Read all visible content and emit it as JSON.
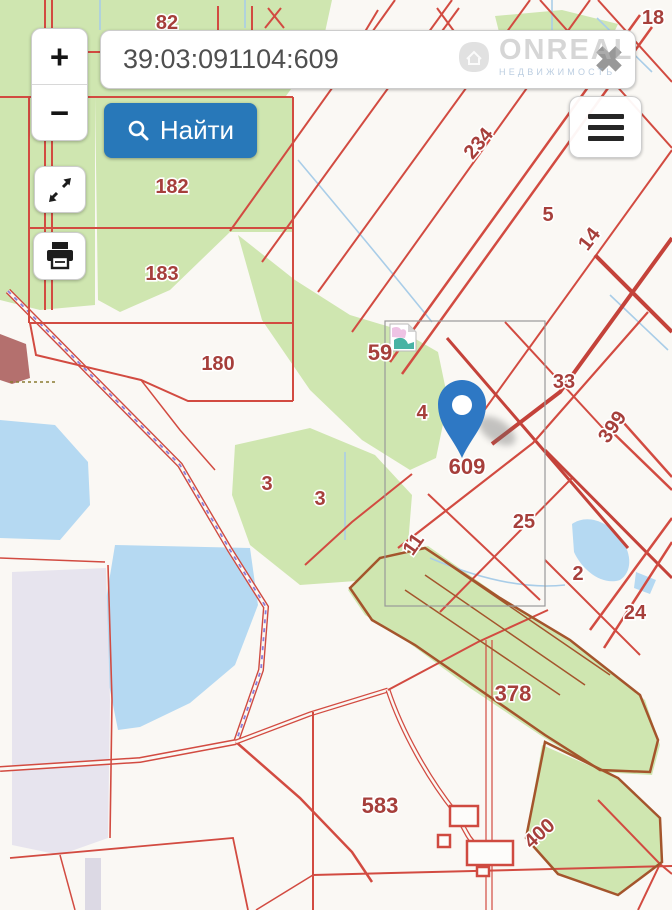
{
  "header": {
    "search": {
      "value": "39:03:091104:609",
      "clear_icon": "✖",
      "find_label": "Найти"
    },
    "zoom_in": "+",
    "zoom_out": "−",
    "watermark": {
      "brand": "ONREAL",
      "tagline": "НЕДВИЖИМОСТЬ"
    }
  },
  "map": {
    "pin_parcel": "609",
    "labels": [
      {
        "text": "82"
      },
      {
        "text": "18"
      },
      {
        "text": "234"
      },
      {
        "text": "5"
      },
      {
        "text": "14"
      },
      {
        "text": "182"
      },
      {
        "text": "183"
      },
      {
        "text": "180"
      },
      {
        "text": "59"
      },
      {
        "text": "4"
      },
      {
        "text": "33"
      },
      {
        "text": "399"
      },
      {
        "text": "609"
      },
      {
        "text": "25"
      },
      {
        "text": "11"
      },
      {
        "text": "3"
      },
      {
        "text": "3"
      },
      {
        "text": "2"
      },
      {
        "text": "24"
      },
      {
        "text": "378"
      },
      {
        "text": "583"
      },
      {
        "text": "400"
      }
    ],
    "colors": {
      "parcel_line": "#d24b41",
      "forest_outline": "#a4552c",
      "green": "#cfe6b0",
      "water": "#b5d9f2",
      "label": "#a63f3b",
      "railway_dash": "#8b7cd8",
      "pin": "#2e78c4",
      "accent_button": "#2878b9"
    }
  }
}
